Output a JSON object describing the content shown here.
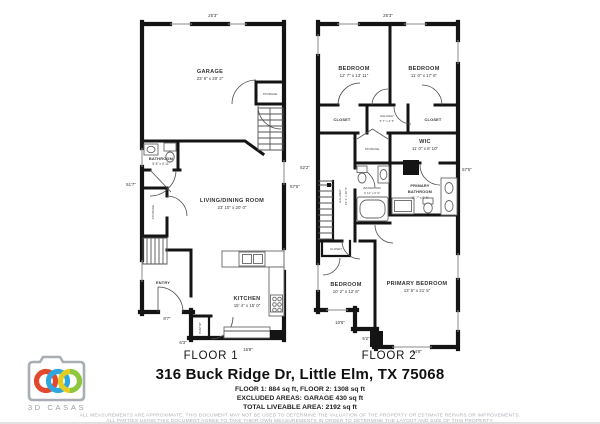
{
  "floor1": {
    "title": "FLOOR 1",
    "garage": {
      "name": "GARAGE",
      "dims": "23' 8\" x 20' 2\""
    },
    "bathroom": {
      "name": "BATHROOM",
      "dims": "5' 8\" x 4' 11\""
    },
    "living": {
      "name": "LIVING/DINING ROOM",
      "dims": "23' 10\" x 20' 0\""
    },
    "kitchen": {
      "name": "KITCHEN",
      "dims": "15' 4\" x 15' 0\""
    },
    "entry": "ENTRY",
    "pantry": "PANTRY",
    "storage_left": "STORAGE",
    "storage_garage": "STORAGE",
    "dim_top": "25'3\"",
    "dim_left": "51'7\"",
    "dim_right": "57'5\"",
    "dim_entry": "8'7\"",
    "dim_mid": "6'3\"",
    "dim_bottom": "16'8\""
  },
  "floor2": {
    "title": "FLOOR 2",
    "bedroom1": {
      "name": "BEDROOM",
      "dims": "12' 7\" x 13' 11\""
    },
    "bedroom2": {
      "name": "BEDROOM",
      "dims": "11' 0\" x 17' 6\""
    },
    "closet1": "CLOSET",
    "closet2": "CLOSET",
    "closet3": "CLOSET",
    "hall_small": {
      "name": "HALLWAY",
      "dims": "5' 7\" x 4' 5\""
    },
    "wic": {
      "name": "WIC",
      "dims": "11' 0\" x 8' 10\""
    },
    "storage": "STORAGE",
    "bathroom": {
      "name": "BATHROOM",
      "dims": "4' 11\" x 9' 9\""
    },
    "primary_bath": {
      "line1": "PRIMARY",
      "line2": "BATHROOM",
      "dims": "11' 7\" x 9' 9\""
    },
    "hallway": {
      "name": "HALLWAY",
      "dims": "10' 2\" x 20' 5\""
    },
    "bedroom3": {
      "name": "BEDROOM",
      "dims": "10' 2\" x 12' 8\""
    },
    "primary_bedroom": {
      "name": "PRIMARY BEDROOM",
      "dims": "13' 5\" x 21' 5\""
    },
    "dim_top": "25'3\"",
    "dim_left": "52'2\"",
    "dim_right": "57'5\"",
    "dim_b1": "10'6\"",
    "dim_b2": "5'2\"",
    "dim_b3": "14'8\""
  },
  "footer": {
    "address": "316 Buck Ridge Dr, Little Elm, TX 75068",
    "areas1": "FLOOR 1: 884 sq ft, FLOOR 2: 1308 sq ft",
    "areas2": "EXCLUDED AREAS: GARAGE 430 sq ft",
    "areas3": "TOTAL LIVEABLE AREA: 2192 sq ft",
    "disclaimer1": "ALL MEASUREMENTS ARE APPROXIMATE. THIS DOCUMENT MAY NOT BE USED TO DETERMINE THE VALUATION OF THE PROPERTY OR ESTIMATE REPAIRS OR IMPROVEMENTS.",
    "disclaimer2": "ALL PARTIES USING THIS DOCUMENT AGREE TO TAKE THEIR OWN MEASUREMENTS IN ORDER TO DETERMINE THE LAYOUT AND SIZE OF THIS PROPERTY."
  },
  "logo": {
    "text": "3D CASAS",
    "camera_color": "#a9aeb4",
    "ring_red": "#e2482e",
    "ring_blue": "#2fa7de",
    "ring_yellow": "#e3cd21",
    "ring_green": "#8dc63f"
  }
}
